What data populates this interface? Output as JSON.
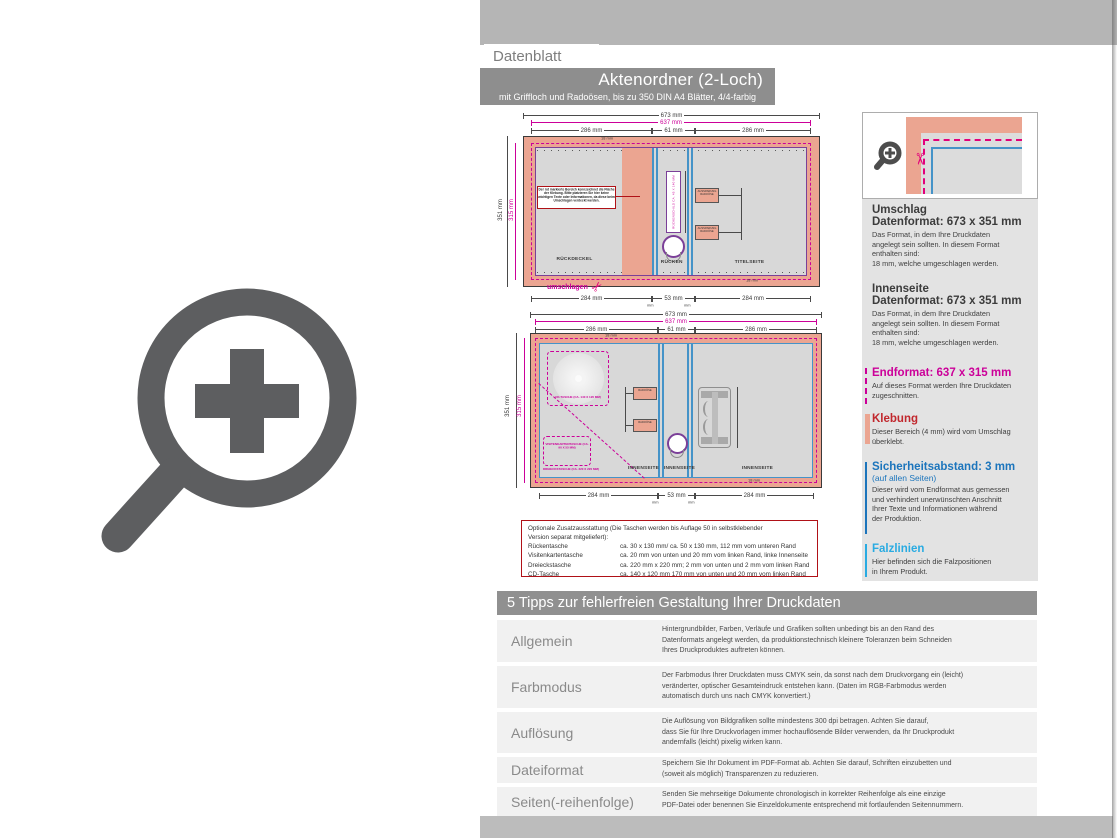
{
  "header": {
    "tag": "Datenblatt",
    "title": "Aktenordner (2-Loch)",
    "subtitle": "mit Griffloch und Radoösen, bis zu 350 DIN A4 Blätter, 4/4-farbig"
  },
  "dims": {
    "w_total": "673 mm",
    "w_end": "637 mm",
    "w_panel": "286 mm",
    "w_spine_top": "61 mm",
    "w_panel_bottom": "284 mm",
    "w_spine_bottom": "53 mm",
    "h_total": "351 mm",
    "h_end": "315 mm",
    "fold": "18 mm",
    "mm": "mm"
  },
  "drawing_top": {
    "label_back": "RÜCKDECKEL",
    "label_spine": "RÜCKEN",
    "label_front": "TITELSEITE",
    "fold_note": "umschlagen",
    "spine_tag": "RÜCKENSCHILD CA. 45 X 140 MM",
    "cutout": "AUSSPARUNG RADOÖSE",
    "note": "Der rot markierte Bereich kennzeichnet die Fläche der Klebung. Bitte platzieren Sie hier keine wichtigen Texte oder Informationen, da diese beim Umschlagen verdeckt werden."
  },
  "drawing_bottom": {
    "label_inner": "INNENSEITE",
    "cd_pocket": "CD-TASCHE (CA. 140 X 120 MM)",
    "card_pocket": "VISITENKARTENTASCHE (CA. 90 X 55 MM)",
    "triangle_pocket": "DREIECKSTASCHE (CA. 220 X 220 MM)",
    "cutout": "RADOÖSE"
  },
  "optional_box": {
    "intro": "Optionale Zusatzausstattung (Die Taschen werden bis Auflage 50 in selbstklebender\nVersion separat mitgeliefert):",
    "rows": [
      {
        "name": "Rückentasche",
        "desc": "ca. 30 x 130 mm/ ca. 50 x 130 mm, 112 mm vom unteren Rand"
      },
      {
        "name": "Visitenkartentasche",
        "desc": "ca. 20 mm von unten und 20 mm vom linken Rand, linke Innenseite"
      },
      {
        "name": "Dreieckstasche",
        "desc": "ca. 220 mm x 220 mm; 2 mm von unten und 2 mm vom linken Rand"
      },
      {
        "name": "CD-Tasche",
        "desc": "ca. 140 x 120 mm 170 mm von unten und 20 mm vom linken Rand"
      }
    ]
  },
  "sidebar": {
    "umschlag": {
      "heading": "Umschlag",
      "subheading": "Datenformat: 673 x 351 mm",
      "body": "Das Format, in dem Ihre Druckdaten\nangelegt sein sollten. In diesem Format\nenthalten sind:\n18 mm, welche umgeschlagen werden."
    },
    "innenseite": {
      "heading": "Innenseite",
      "subheading": "Datenformat: 673 x 351 mm",
      "body": "Das Format, in dem Ihre Druckdaten\nangelegt sein sollten. In diesem Format\nenthalten sind:\n18 mm, welche umgeschlagen werden."
    },
    "endformat": {
      "heading": "Endformat: 637 x 315 mm",
      "body": "Auf dieses Format werden Ihre Druckdaten\nzugeschnitten."
    },
    "klebung": {
      "heading": "Klebung",
      "body": "Dieser Bereich (4 mm) wird vom Umschlag\nüberklebt."
    },
    "sicherheitsabstand": {
      "heading": "Sicherheitsabstand: 3 mm",
      "subheading": "(auf allen Seiten)",
      "body": "Dieser wird vom Endformat aus gemessen\nund verhindert unerwünschten Anschnitt\nIhrer Texte und Informationen während\nder Produktion."
    },
    "falzlinien": {
      "heading": "Falzlinien",
      "body": "Hier befinden sich die Falzpositionen\nin Ihrem Produkt."
    }
  },
  "tips": {
    "title": "5 Tipps zur fehlerfreien Gestaltung Ihrer Druckdaten",
    "rows": [
      {
        "label": "Allgemein",
        "text": "Hintergrundbilder, Farben, Verläufe und Grafiken sollten unbedingt bis an den Rand des\nDatenformats angelegt werden, da produktionstechnisch kleinere Toleranzen beim Schneiden\nIhres Druckproduktes auftreten können."
      },
      {
        "label": "Farbmodus",
        "text": "Der Farbmodus Ihrer Druckdaten muss CMYK sein, da sonst nach dem Druckvorgang ein (leicht)\nveränderter, optischer Gesamteindruck entstehen kann. (Daten im RGB-Farbmodus werden\nautomatisch durch uns nach CMYK konvertiert.)"
      },
      {
        "label": "Auflösung",
        "text": "Die Auflösung von Bildgrafiken sollte mindestens 300 dpi betragen. Achten Sie darauf,\ndass Sie für Ihre Druckvorlagen immer hochauflösende Bilder verwenden, da Ihr Druckprodukt\nandernfalls (leicht) pixelig wirken kann."
      },
      {
        "label": "Dateiformat",
        "text": "Speichern Sie Ihr Dokument im PDF-Format ab. Achten Sie darauf, Schriften einzubetten und\n(soweit als möglich) Transparenzen zu reduzieren."
      },
      {
        "label": "Seiten(-reihenfolge)",
        "text": "Senden Sie mehrseitige Dokumente chronologisch in korrekter Reihenfolge als eine einzige\nPDF-Datei oder benennen Sie Einzeldokumente entsprechend mit fortlaufenden Seitennummern."
      }
    ]
  },
  "colors": {
    "accent_magenta": "#cc0099",
    "salmon": "#eba591",
    "blue_line": "#4593c8",
    "purple_line": "#7b3f98",
    "red_heading": "#c1272d",
    "blue_heading": "#1c75bc",
    "cyan_heading": "#29abe2",
    "gray_band": "#b5b5b5",
    "gray_titlebar": "#8e8e8e"
  }
}
